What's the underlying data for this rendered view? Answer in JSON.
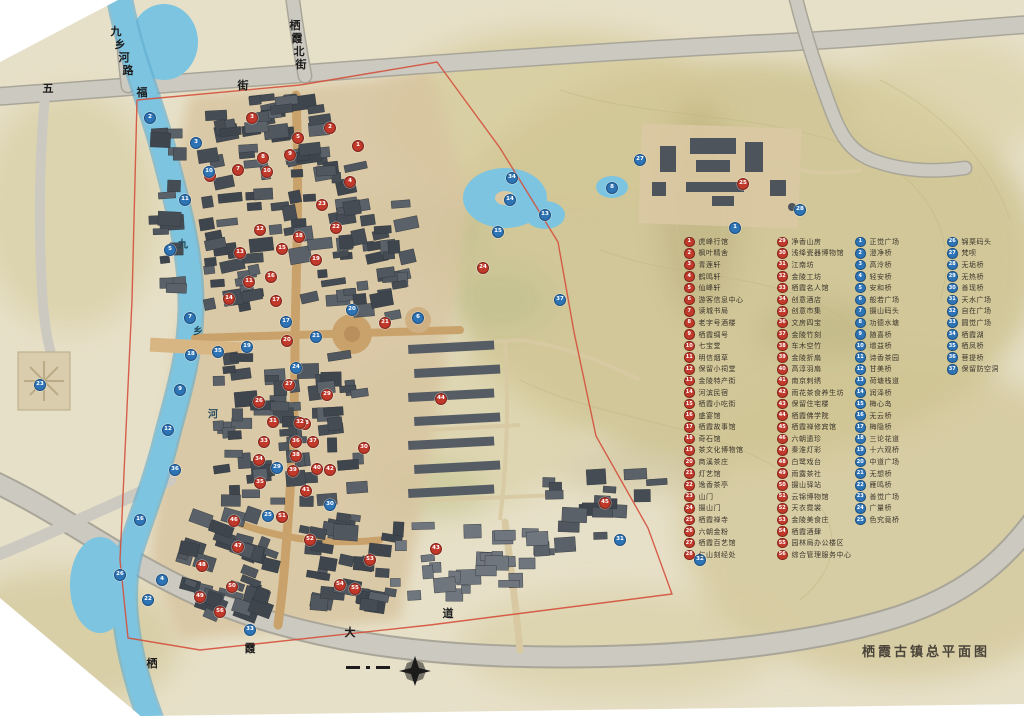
{
  "title": "栖霞古镇总平面图",
  "colors": {
    "paper": "#e7e0c8",
    "hill": "#cdc28f",
    "water": "#7cc4e0",
    "road": "#ccc9c0",
    "building": "#474e54",
    "old_street": "#c9a26b",
    "red_marker": "#c0392b",
    "blue_marker": "#2e74b5",
    "boundary": "#d4503c"
  },
  "road_labels": [
    {
      "name": "五福街",
      "chars": [
        [
          "五",
          48,
          88
        ],
        [
          "福",
          142,
          92
        ],
        [
          "街",
          243,
          85
        ]
      ]
    },
    {
      "name": "九乡河路",
      "chars": [
        [
          "九",
          116,
          31
        ],
        [
          "乡",
          120,
          44
        ],
        [
          "河",
          124,
          57
        ],
        [
          "路",
          128,
          70
        ]
      ]
    },
    {
      "name": "栖霞北街",
      "chars": [
        [
          "栖",
          295,
          25
        ],
        [
          "霞",
          297,
          38
        ],
        [
          "北",
          299,
          51
        ],
        [
          "街",
          301,
          64
        ]
      ]
    },
    {
      "name": "栖霞大道",
      "chars": [
        [
          "栖",
          152,
          663
        ],
        [
          "霞",
          250,
          648
        ],
        [
          "大",
          350,
          632
        ],
        [
          "道",
          448,
          613
        ]
      ]
    }
  ],
  "river_label": {
    "name": "九乡河",
    "chars": [
      [
        "九",
        183,
        243
      ],
      [
        "乡",
        198,
        330
      ],
      [
        "河",
        213,
        413
      ]
    ]
  },
  "legend": {
    "columns": [
      {
        "type": "red",
        "x": 684,
        "y": 236,
        "items": [
          {
            "n": 1,
            "label": "虎峰行馆"
          },
          {
            "n": 2,
            "label": "枫叶精舍"
          },
          {
            "n": 3,
            "label": "青莲轩"
          },
          {
            "n": 4,
            "label": "鹤鸣轩"
          },
          {
            "n": 5,
            "label": "仙峰轩"
          },
          {
            "n": 6,
            "label": "游客信息中心"
          },
          {
            "n": 7,
            "label": "读城书局"
          },
          {
            "n": 8,
            "label": "老字号酒楼"
          },
          {
            "n": 9,
            "label": "栖霞绸号"
          },
          {
            "n": 10,
            "label": "七宝堂"
          },
          {
            "n": 11,
            "label": "明信烟草"
          },
          {
            "n": 12,
            "label": "保留小祠堂"
          },
          {
            "n": 13,
            "label": "金陵特产街"
          },
          {
            "n": 14,
            "label": "河滨民宿"
          },
          {
            "n": 15,
            "label": "栖霞小吃街"
          },
          {
            "n": 16,
            "label": "盛宴馆"
          },
          {
            "n": 17,
            "label": "栖霞故事馆"
          },
          {
            "n": 18,
            "label": "奇石馆"
          },
          {
            "n": 19,
            "label": "茶文化博物馆"
          },
          {
            "n": 20,
            "label": "商溪茶庄"
          },
          {
            "n": 21,
            "label": "灯艺馆"
          },
          {
            "n": 22,
            "label": "逸香茶亭"
          },
          {
            "n": 23,
            "label": "山门"
          },
          {
            "n": 24,
            "label": "摄山门"
          },
          {
            "n": 25,
            "label": "栖霞禅寺"
          },
          {
            "n": 26,
            "label": "六朝金粉"
          },
          {
            "n": 27,
            "label": "栖霞百艺馆"
          },
          {
            "n": 28,
            "label": "仁山刻经处"
          }
        ]
      },
      {
        "type": "red",
        "x": 777,
        "y": 236,
        "items": [
          {
            "n": 29,
            "label": "净香山房"
          },
          {
            "n": 30,
            "label": "浅绛瓷器博物馆"
          },
          {
            "n": 31,
            "label": "江南坊"
          },
          {
            "n": 32,
            "label": "金陵工坊"
          },
          {
            "n": 33,
            "label": "栖霞名人馆"
          },
          {
            "n": 34,
            "label": "创意酒店"
          },
          {
            "n": 35,
            "label": "创意市集"
          },
          {
            "n": 36,
            "label": "文房四宝"
          },
          {
            "n": 37,
            "label": "金陵竹刻"
          },
          {
            "n": 38,
            "label": "车木空竹"
          },
          {
            "n": 39,
            "label": "金陵折扇"
          },
          {
            "n": 40,
            "label": "高淳羽扇"
          },
          {
            "n": 41,
            "label": "南京刺绣"
          },
          {
            "n": 42,
            "label": "雨花茶食养生坊"
          },
          {
            "n": 43,
            "label": "保留住宅楼"
          },
          {
            "n": 44,
            "label": "栖霞佛学院"
          },
          {
            "n": 45,
            "label": "栖霞禅修宾馆"
          },
          {
            "n": 46,
            "label": "六朝遗珍"
          },
          {
            "n": 47,
            "label": "秦淮灯彩"
          },
          {
            "n": 48,
            "label": "白鹭戏台"
          },
          {
            "n": 49,
            "label": "雨露茶社"
          },
          {
            "n": 50,
            "label": "摄山驿站"
          },
          {
            "n": 51,
            "label": "云锦博物馆"
          },
          {
            "n": 52,
            "label": "天衣霓裳"
          },
          {
            "n": 53,
            "label": "金陵美食庄"
          },
          {
            "n": 54,
            "label": "栖霞酒肆"
          },
          {
            "n": 55,
            "label": "园林局办公楼区"
          },
          {
            "n": 56,
            "label": "综合管理服务中心"
          }
        ]
      },
      {
        "type": "blue",
        "x": 855,
        "y": 236,
        "items": [
          {
            "n": 1,
            "label": "正觉广场"
          },
          {
            "n": 2,
            "label": "澄净桥"
          },
          {
            "n": 3,
            "label": "高泠桥"
          },
          {
            "n": 4,
            "label": "轻安桥"
          },
          {
            "n": 5,
            "label": "安和桥"
          },
          {
            "n": 6,
            "label": "般若广场"
          },
          {
            "n": 7,
            "label": "摄山码头"
          },
          {
            "n": 8,
            "label": "功德水塘"
          },
          {
            "n": 9,
            "label": "随喜桥"
          },
          {
            "n": 10,
            "label": "增益桥"
          },
          {
            "n": 11,
            "label": "诗香茶园"
          },
          {
            "n": 12,
            "label": "甘美桥"
          },
          {
            "n": 13,
            "label": "荷塘栈道"
          },
          {
            "n": 14,
            "label": "润泽桥"
          },
          {
            "n": 15,
            "label": "梅心岛"
          },
          {
            "n": 16,
            "label": "无云桥"
          },
          {
            "n": 17,
            "label": "梅隐桥"
          },
          {
            "n": 18,
            "label": "三论花道"
          },
          {
            "n": 19,
            "label": "十六观桥"
          },
          {
            "n": 20,
            "label": "中道广场"
          },
          {
            "n": 21,
            "label": "无想桥"
          },
          {
            "n": 22,
            "label": "雁鸣桥"
          },
          {
            "n": 23,
            "label": "善觉广场"
          },
          {
            "n": 24,
            "label": "广量桥"
          },
          {
            "n": 25,
            "label": "色究竟桥"
          }
        ]
      },
      {
        "type": "blue",
        "x": 947,
        "y": 236,
        "items": [
          {
            "n": 26,
            "label": "锦栗码头"
          },
          {
            "n": 27,
            "label": "梵呗"
          },
          {
            "n": 28,
            "label": "无垢桥"
          },
          {
            "n": 29,
            "label": "无热桥"
          },
          {
            "n": 30,
            "label": "善现桥"
          },
          {
            "n": 31,
            "label": "天水广场"
          },
          {
            "n": 32,
            "label": "自在广场"
          },
          {
            "n": 33,
            "label": "圆觉广场"
          },
          {
            "n": 34,
            "label": "栖霞湖"
          },
          {
            "n": 35,
            "label": "栖凤桥"
          },
          {
            "n": 36,
            "label": "菩提桥"
          },
          {
            "n": 37,
            "label": "保留防空洞"
          }
        ]
      }
    ]
  },
  "map_markers": {
    "red": [
      {
        "n": 1,
        "x": 358,
        "y": 146
      },
      {
        "n": 2,
        "x": 330,
        "y": 128
      },
      {
        "n": 3,
        "x": 252,
        "y": 118
      },
      {
        "n": 4,
        "x": 350,
        "y": 182
      },
      {
        "n": 5,
        "x": 298,
        "y": 138
      },
      {
        "n": 6,
        "x": 210,
        "y": 176
      },
      {
        "n": 7,
        "x": 238,
        "y": 170
      },
      {
        "n": 8,
        "x": 263,
        "y": 158
      },
      {
        "n": 9,
        "x": 290,
        "y": 155
      },
      {
        "n": 10,
        "x": 267,
        "y": 172
      },
      {
        "n": 11,
        "x": 249,
        "y": 282
      },
      {
        "n": 12,
        "x": 260,
        "y": 230
      },
      {
        "n": 13,
        "x": 240,
        "y": 253
      },
      {
        "n": 14,
        "x": 229,
        "y": 299
      },
      {
        "n": 15,
        "x": 282,
        "y": 249
      },
      {
        "n": 16,
        "x": 271,
        "y": 277
      },
      {
        "n": 17,
        "x": 276,
        "y": 301
      },
      {
        "n": 18,
        "x": 299,
        "y": 237
      },
      {
        "n": 19,
        "x": 316,
        "y": 260
      },
      {
        "n": 20,
        "x": 287,
        "y": 341
      },
      {
        "n": 21,
        "x": 385,
        "y": 323
      },
      {
        "n": 22,
        "x": 336,
        "y": 228
      },
      {
        "n": 23,
        "x": 322,
        "y": 205
      },
      {
        "n": 24,
        "x": 483,
        "y": 268
      },
      {
        "n": 25,
        "x": 743,
        "y": 184
      },
      {
        "n": 26,
        "x": 259,
        "y": 402
      },
      {
        "n": 27,
        "x": 289,
        "y": 385
      },
      {
        "n": 28,
        "x": 305,
        "y": 424
      },
      {
        "n": 29,
        "x": 327,
        "y": 395
      },
      {
        "n": 30,
        "x": 364,
        "y": 448
      },
      {
        "n": 31,
        "x": 273,
        "y": 422
      },
      {
        "n": 32,
        "x": 300,
        "y": 423
      },
      {
        "n": 33,
        "x": 264,
        "y": 442
      },
      {
        "n": 34,
        "x": 259,
        "y": 460
      },
      {
        "n": 35,
        "x": 260,
        "y": 483
      },
      {
        "n": 36,
        "x": 296,
        "y": 442
      },
      {
        "n": 37,
        "x": 313,
        "y": 442
      },
      {
        "n": 38,
        "x": 296,
        "y": 456
      },
      {
        "n": 39,
        "x": 293,
        "y": 471
      },
      {
        "n": 40,
        "x": 317,
        "y": 469
      },
      {
        "n": 41,
        "x": 306,
        "y": 491
      },
      {
        "n": 42,
        "x": 330,
        "y": 470
      },
      {
        "n": 43,
        "x": 436,
        "y": 549
      },
      {
        "n": 44,
        "x": 441,
        "y": 399
      },
      {
        "n": 45,
        "x": 605,
        "y": 503
      },
      {
        "n": 46,
        "x": 234,
        "y": 521
      },
      {
        "n": 47,
        "x": 238,
        "y": 547
      },
      {
        "n": 48,
        "x": 202,
        "y": 566
      },
      {
        "n": 49,
        "x": 200,
        "y": 597
      },
      {
        "n": 50,
        "x": 232,
        "y": 587
      },
      {
        "n": 51,
        "x": 282,
        "y": 517
      },
      {
        "n": 52,
        "x": 310,
        "y": 540
      },
      {
        "n": 53,
        "x": 370,
        "y": 560
      },
      {
        "n": 54,
        "x": 340,
        "y": 585
      },
      {
        "n": 55,
        "x": 355,
        "y": 589
      },
      {
        "n": 56,
        "x": 220,
        "y": 612
      }
    ],
    "blue": [
      {
        "n": 1,
        "x": 735,
        "y": 228
      },
      {
        "n": 2,
        "x": 150,
        "y": 118
      },
      {
        "n": 3,
        "x": 196,
        "y": 143
      },
      {
        "n": 4,
        "x": 162,
        "y": 580
      },
      {
        "n": 5,
        "x": 170,
        "y": 250
      },
      {
        "n": 6,
        "x": 418,
        "y": 318
      },
      {
        "n": 7,
        "x": 190,
        "y": 318
      },
      {
        "n": 8,
        "x": 612,
        "y": 188
      },
      {
        "n": 9,
        "x": 180,
        "y": 390
      },
      {
        "n": 10,
        "x": 209,
        "y": 172
      },
      {
        "n": 11,
        "x": 185,
        "y": 200
      },
      {
        "n": 12,
        "x": 168,
        "y": 430
      },
      {
        "n": 13,
        "x": 545,
        "y": 215
      },
      {
        "n": 14,
        "x": 510,
        "y": 200
      },
      {
        "n": 15,
        "x": 498,
        "y": 232
      },
      {
        "n": 16,
        "x": 140,
        "y": 520
      },
      {
        "n": 17,
        "x": 286,
        "y": 322
      },
      {
        "n": 18,
        "x": 191,
        "y": 355
      },
      {
        "n": 19,
        "x": 247,
        "y": 347
      },
      {
        "n": 20,
        "x": 352,
        "y": 310
      },
      {
        "n": 21,
        "x": 316,
        "y": 337
      },
      {
        "n": 22,
        "x": 148,
        "y": 600
      },
      {
        "n": 23,
        "x": 40,
        "y": 385
      },
      {
        "n": 24,
        "x": 296,
        "y": 368
      },
      {
        "n": 25,
        "x": 268,
        "y": 516
      },
      {
        "n": 26,
        "x": 120,
        "y": 575
      },
      {
        "n": 27,
        "x": 640,
        "y": 160
      },
      {
        "n": 28,
        "x": 800,
        "y": 210
      },
      {
        "n": 29,
        "x": 277,
        "y": 468
      },
      {
        "n": 30,
        "x": 330,
        "y": 505
      },
      {
        "n": 31,
        "x": 620,
        "y": 540
      },
      {
        "n": 32,
        "x": 700,
        "y": 560
      },
      {
        "n": 33,
        "x": 250,
        "y": 630
      },
      {
        "n": 34,
        "x": 512,
        "y": 178
      },
      {
        "n": 35,
        "x": 218,
        "y": 352
      },
      {
        "n": 36,
        "x": 175,
        "y": 470
      },
      {
        "n": 37,
        "x": 560,
        "y": 300
      }
    ]
  }
}
